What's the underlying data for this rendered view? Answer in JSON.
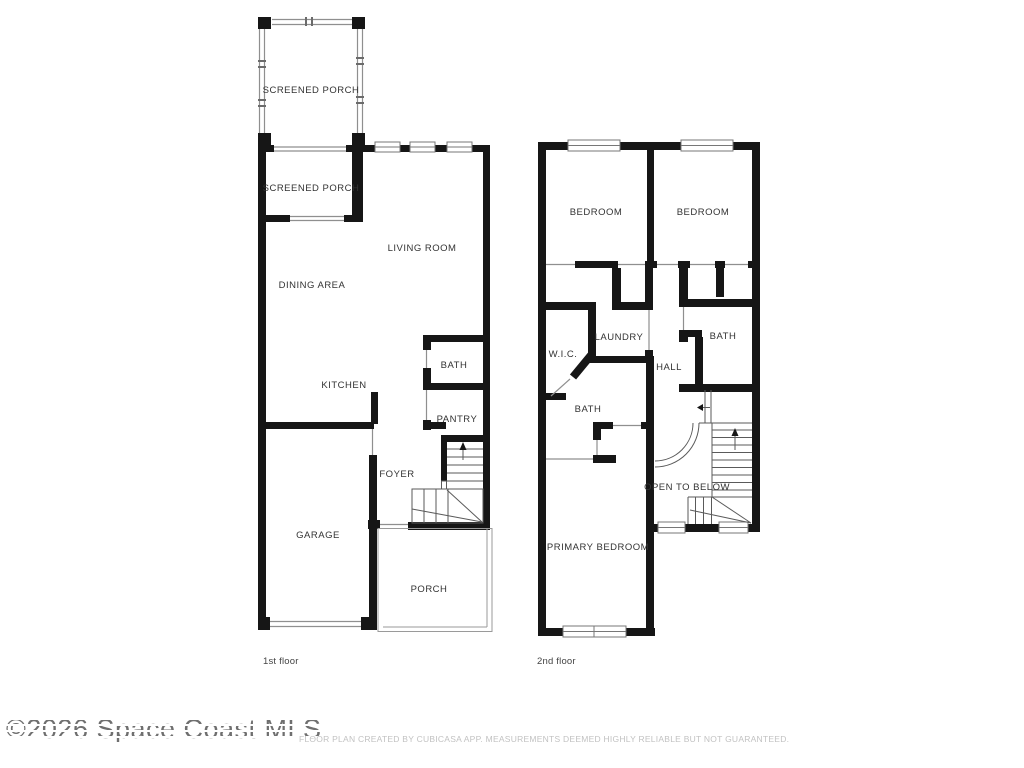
{
  "page": {
    "watermark": "©2026 Space Coast MLS",
    "disclaimer": "FLOOR PLAN CREATED BY CUBICASA APP. MEASUREMENTS DEEMED HIGHLY RELIABLE BUT NOT GUARANTEED."
  },
  "colors": {
    "wall": "#161616",
    "door_line": "#8f8f8f",
    "stair_line": "#5a5a5a",
    "label_text": "#333333",
    "watermark_text": "#6f6f6f",
    "disclaimer_text": "#c2c2c2"
  },
  "floors": [
    {
      "name": "1st floor",
      "rooms": [
        "SCREENED PORCH",
        "SCREENED PORCH",
        "LIVING ROOM",
        "DINING AREA",
        "KITCHEN",
        "BATH",
        "PANTRY",
        "FOYER",
        "GARAGE",
        "PORCH"
      ]
    },
    {
      "name": "2nd floor",
      "rooms": [
        "BEDROOM",
        "BEDROOM",
        "W.I.C.",
        "LAUNDRY",
        "HALL",
        "BATH",
        "BATH",
        "OPEN TO BELOW",
        "PRIMARY BEDROOM"
      ]
    }
  ]
}
